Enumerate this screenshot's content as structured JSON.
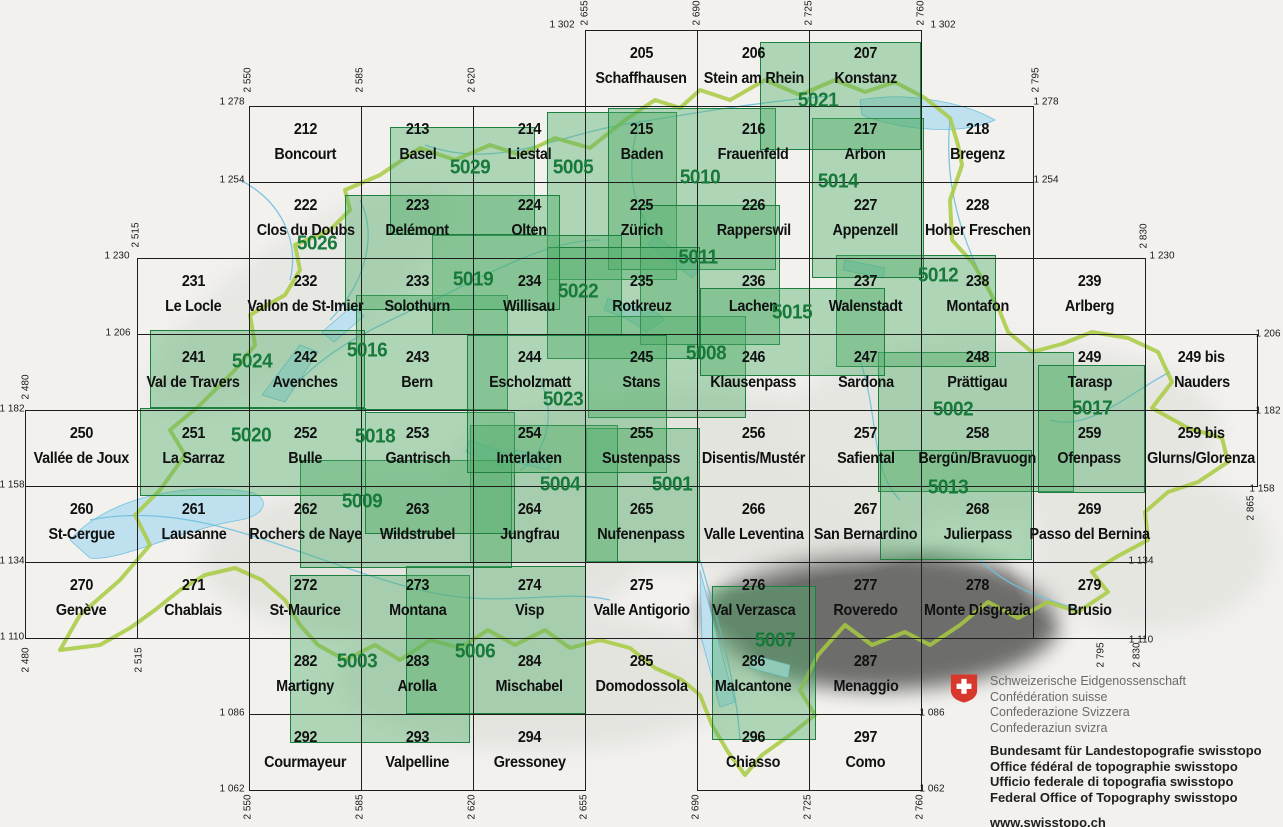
{
  "colors": {
    "composite_green": "#17793a",
    "composite_fill": "rgba(80,175,105,0.42)",
    "swiss_red": "#d8372c",
    "border_green": "#a8ca3f",
    "water_blue": "#6fc0dd"
  },
  "grid": {
    "x0_km": 2550,
    "x0_px": 249,
    "px_per_km_x": 3.2,
    "y0_km": 1302,
    "y0_px": 30,
    "px_per_km_y": 3.1667,
    "sheet_w_km": 35,
    "sheet_h_km": 24
  },
  "sheets": [
    {
      "n": "205",
      "name": "Schaffhausen",
      "x": 2655,
      "y": 1302
    },
    {
      "n": "206",
      "name": "Stein am Rhein",
      "x": 2690,
      "y": 1302
    },
    {
      "n": "207",
      "name": "Konstanz",
      "x": 2725,
      "y": 1302
    },
    {
      "n": "212",
      "name": "Boncourt",
      "x": 2550,
      "y": 1278
    },
    {
      "n": "213",
      "name": "Basel",
      "x": 2585,
      "y": 1278
    },
    {
      "n": "214",
      "name": "Liestal",
      "x": 2620,
      "y": 1278
    },
    {
      "n": "215",
      "name": "Baden",
      "x": 2655,
      "y": 1278
    },
    {
      "n": "216",
      "name": "Frauenfeld",
      "x": 2690,
      "y": 1278
    },
    {
      "n": "217",
      "name": "Arbon",
      "x": 2725,
      "y": 1278
    },
    {
      "n": "218",
      "name": "Bregenz",
      "x": 2760,
      "y": 1278
    },
    {
      "n": "222",
      "name": "Clos du Doubs",
      "x": 2550,
      "y": 1254
    },
    {
      "n": "223",
      "name": "Delémont",
      "x": 2585,
      "y": 1254
    },
    {
      "n": "224",
      "name": "Olten",
      "x": 2620,
      "y": 1254
    },
    {
      "n": "225",
      "name": "Zürich",
      "x": 2655,
      "y": 1254
    },
    {
      "n": "226",
      "name": "Rapperswil",
      "x": 2690,
      "y": 1254
    },
    {
      "n": "227",
      "name": "Appenzell",
      "x": 2725,
      "y": 1254
    },
    {
      "n": "228",
      "name": "Hoher Freschen",
      "x": 2760,
      "y": 1254
    },
    {
      "n": "231",
      "name": "Le Locle",
      "x": 2515,
      "y": 1230
    },
    {
      "n": "232",
      "name": "Vallon de St-Imier",
      "x": 2550,
      "y": 1230
    },
    {
      "n": "233",
      "name": "Solothurn",
      "x": 2585,
      "y": 1230
    },
    {
      "n": "234",
      "name": "Willisau",
      "x": 2620,
      "y": 1230
    },
    {
      "n": "235",
      "name": "Rotkreuz",
      "x": 2655,
      "y": 1230
    },
    {
      "n": "236",
      "name": "Lachen",
      "x": 2690,
      "y": 1230
    },
    {
      "n": "237",
      "name": "Walenstadt",
      "x": 2725,
      "y": 1230
    },
    {
      "n": "238",
      "name": "Montafon",
      "x": 2760,
      "y": 1230
    },
    {
      "n": "239",
      "name": "Arlberg",
      "x": 2795,
      "y": 1230
    },
    {
      "n": "241",
      "name": "Val de Travers",
      "x": 2515,
      "y": 1206
    },
    {
      "n": "242",
      "name": "Avenches",
      "x": 2550,
      "y": 1206
    },
    {
      "n": "243",
      "name": "Bern",
      "x": 2585,
      "y": 1206
    },
    {
      "n": "244",
      "name": "Escholzmatt",
      "x": 2620,
      "y": 1206
    },
    {
      "n": "245",
      "name": "Stans",
      "x": 2655,
      "y": 1206
    },
    {
      "n": "246",
      "name": "Klausenpass",
      "x": 2690,
      "y": 1206
    },
    {
      "n": "247",
      "name": "Sardona",
      "x": 2725,
      "y": 1206
    },
    {
      "n": "248",
      "name": "Prättigau",
      "x": 2760,
      "y": 1206
    },
    {
      "n": "249",
      "name": "Tarasp",
      "x": 2795,
      "y": 1206
    },
    {
      "n": "249 bis",
      "name": "Nauders",
      "x": 2830,
      "y": 1206
    },
    {
      "n": "250",
      "name": "Vallée de Joux",
      "x": 2480,
      "y": 1182
    },
    {
      "n": "251",
      "name": "La Sarraz",
      "x": 2515,
      "y": 1182
    },
    {
      "n": "252",
      "name": "Bulle",
      "x": 2550,
      "y": 1182
    },
    {
      "n": "253",
      "name": "Gantrisch",
      "x": 2585,
      "y": 1182
    },
    {
      "n": "254",
      "name": "Interlaken",
      "x": 2620,
      "y": 1182
    },
    {
      "n": "255",
      "name": "Sustenpass",
      "x": 2655,
      "y": 1182
    },
    {
      "n": "256",
      "name": "Disentis/Mustér",
      "x": 2690,
      "y": 1182
    },
    {
      "n": "257",
      "name": "Safiental",
      "x": 2725,
      "y": 1182
    },
    {
      "n": "258",
      "name": "Bergün/Bravuogn",
      "x": 2760,
      "y": 1182
    },
    {
      "n": "259",
      "name": "Ofenpass",
      "x": 2795,
      "y": 1182
    },
    {
      "n": "259 bis",
      "name": "Glurns/Glorenza",
      "x": 2830,
      "y": 1182
    },
    {
      "n": "260",
      "name": "St-Cergue",
      "x": 2480,
      "y": 1158
    },
    {
      "n": "261",
      "name": "Lausanne",
      "x": 2515,
      "y": 1158
    },
    {
      "n": "262",
      "name": "Rochers de Naye",
      "x": 2550,
      "y": 1158
    },
    {
      "n": "263",
      "name": "Wildstrubel",
      "x": 2585,
      "y": 1158
    },
    {
      "n": "264",
      "name": "Jungfrau",
      "x": 2620,
      "y": 1158
    },
    {
      "n": "265",
      "name": "Nufenenpass",
      "x": 2655,
      "y": 1158
    },
    {
      "n": "266",
      "name": "Valle Leventina",
      "x": 2690,
      "y": 1158
    },
    {
      "n": "267",
      "name": "San Bernardino",
      "x": 2725,
      "y": 1158
    },
    {
      "n": "268",
      "name": "Julierpass",
      "x": 2760,
      "y": 1158
    },
    {
      "n": "269",
      "name": "Passo del Bernina",
      "x": 2795,
      "y": 1158
    },
    {
      "n": "270",
      "name": "Genève",
      "x": 2480,
      "y": 1134
    },
    {
      "n": "271",
      "name": "Chablais",
      "x": 2515,
      "y": 1134
    },
    {
      "n": "272",
      "name": "St-Maurice",
      "x": 2550,
      "y": 1134
    },
    {
      "n": "273",
      "name": "Montana",
      "x": 2585,
      "y": 1134
    },
    {
      "n": "274",
      "name": "Visp",
      "x": 2620,
      "y": 1134
    },
    {
      "n": "275",
      "name": "Valle Antigorio",
      "x": 2655,
      "y": 1134
    },
    {
      "n": "276",
      "name": "Val Verzasca",
      "x": 2690,
      "y": 1134
    },
    {
      "n": "277",
      "name": "Roveredo",
      "x": 2725,
      "y": 1134
    },
    {
      "n": "278",
      "name": "Monte Disgrazia",
      "x": 2760,
      "y": 1134
    },
    {
      "n": "279",
      "name": "Brusio",
      "x": 2795,
      "y": 1134
    },
    {
      "n": "282",
      "name": "Martigny",
      "x": 2550,
      "y": 1110
    },
    {
      "n": "283",
      "name": "Arolla",
      "x": 2585,
      "y": 1110
    },
    {
      "n": "284",
      "name": "Mischabel",
      "x": 2620,
      "y": 1110
    },
    {
      "n": "285",
      "name": "Domodossola",
      "x": 2655,
      "y": 1110
    },
    {
      "n": "286",
      "name": "Malcantone",
      "x": 2690,
      "y": 1110
    },
    {
      "n": "287",
      "name": "Menaggio",
      "x": 2725,
      "y": 1110
    },
    {
      "n": "292",
      "name": "Courmayeur",
      "x": 2550,
      "y": 1086
    },
    {
      "n": "293",
      "name": "Valpelline",
      "x": 2585,
      "y": 1086
    },
    {
      "n": "294",
      "name": "Gressoney",
      "x": 2620,
      "y": 1086
    },
    {
      "n": "296",
      "name": "Chiasso",
      "x": 2690,
      "y": 1086
    },
    {
      "n": "297",
      "name": "Como",
      "x": 2725,
      "y": 1086
    }
  ],
  "composites": [
    {
      "n": "5001",
      "rect": [
        586,
        428,
        114,
        134
      ],
      "label": [
        672,
        485
      ]
    },
    {
      "n": "5002",
      "rect": [
        878,
        352,
        196,
        140
      ],
      "label": [
        953,
        410
      ]
    },
    {
      "n": "5003",
      "rect": [
        290,
        575,
        180,
        168
      ],
      "label": [
        357,
        662
      ]
    },
    {
      "n": "5004",
      "rect": [
        470,
        425,
        148,
        138
      ],
      "label": [
        560,
        485
      ]
    },
    {
      "n": "5005",
      "rect": [
        547,
        112,
        130,
        168
      ],
      "label": [
        573,
        168
      ]
    },
    {
      "n": "5006",
      "rect": [
        406,
        566,
        180,
        148
      ],
      "label": [
        475,
        652
      ]
    },
    {
      "n": "5007",
      "rect": [
        712,
        586,
        104,
        154
      ],
      "label": [
        775,
        641
      ]
    },
    {
      "n": "5008",
      "rect": [
        588,
        316,
        158,
        102
      ],
      "label": [
        706,
        354
      ]
    },
    {
      "n": "5009",
      "rect": [
        300,
        460,
        212,
        108
      ],
      "label": [
        362,
        502
      ]
    },
    {
      "n": "5010",
      "rect": [
        608,
        108,
        168,
        162
      ],
      "label": [
        700,
        178
      ]
    },
    {
      "n": "5011",
      "rect": [
        640,
        205,
        140,
        140
      ],
      "label": [
        698,
        258
      ]
    },
    {
      "n": "5012",
      "rect": [
        836,
        255,
        160,
        112
      ],
      "label": [
        938,
        276
      ]
    },
    {
      "n": "5013",
      "rect": [
        880,
        450,
        152,
        110
      ],
      "label": [
        948,
        488
      ]
    },
    {
      "n": "5014",
      "rect": [
        812,
        118,
        112,
        160
      ],
      "label": [
        838,
        182
      ]
    },
    {
      "n": "5015",
      "rect": [
        700,
        288,
        185,
        88
      ],
      "label": [
        792,
        313
      ]
    },
    {
      "n": "5016",
      "rect": [
        356,
        295,
        152,
        115
      ],
      "label": [
        367,
        351
      ]
    },
    {
      "n": "5017",
      "rect": [
        1038,
        365,
        107,
        128
      ],
      "label": [
        1092,
        409
      ]
    },
    {
      "n": "5018",
      "rect": [
        365,
        412,
        150,
        122
      ],
      "label": [
        375,
        437
      ]
    },
    {
      "n": "5019",
      "rect": [
        432,
        235,
        190,
        100
      ],
      "label": [
        473,
        280
      ]
    },
    {
      "n": "5020",
      "rect": [
        140,
        408,
        226,
        88
      ],
      "label": [
        251,
        436
      ]
    },
    {
      "n": "5021",
      "rect": [
        760,
        42,
        161,
        108
      ],
      "label": [
        818,
        101
      ]
    },
    {
      "n": "5022",
      "rect": [
        547,
        247,
        153,
        112
      ],
      "label": [
        578,
        292
      ]
    },
    {
      "n": "5023",
      "rect": [
        467,
        335,
        200,
        138
      ],
      "label": [
        563,
        400
      ]
    },
    {
      "n": "5024",
      "rect": [
        150,
        330,
        215,
        78
      ],
      "label": [
        252,
        362
      ]
    },
    {
      "n": "5026",
      "rect": [
        345,
        195,
        215,
        115
      ],
      "label": [
        317,
        244
      ]
    },
    {
      "n": "5029",
      "rect": [
        390,
        127,
        145,
        108
      ],
      "label": [
        470,
        168
      ]
    }
  ],
  "edge_labels": {
    "horizontal": [
      {
        "t": "1 302",
        "x": 562,
        "y": 25
      },
      {
        "t": "1 302",
        "x": 943,
        "y": 25
      },
      {
        "t": "1 278",
        "x": 232,
        "y": 102
      },
      {
        "t": "1 278",
        "x": 1046,
        "y": 102
      },
      {
        "t": "1 254",
        "x": 232,
        "y": 180
      },
      {
        "t": "1 254",
        "x": 1046,
        "y": 180
      },
      {
        "t": "1 230",
        "x": 117,
        "y": 256
      },
      {
        "t": "1 230",
        "x": 1162,
        "y": 256
      },
      {
        "t": "1 206",
        "x": 118,
        "y": 333
      },
      {
        "t": "1 206",
        "x": 1268,
        "y": 334
      },
      {
        "t": "1 182",
        "x": 12,
        "y": 409
      },
      {
        "t": "1 182",
        "x": 1268,
        "y": 411
      },
      {
        "t": "1 158",
        "x": 12,
        "y": 485
      },
      {
        "t": "1 158",
        "x": 1262,
        "y": 489
      },
      {
        "t": "1 134",
        "x": 12,
        "y": 561
      },
      {
        "t": "1 134",
        "x": 1141,
        "y": 561
      },
      {
        "t": "1 110",
        "x": 12,
        "y": 637
      },
      {
        "t": "1 110",
        "x": 1141,
        "y": 640
      },
      {
        "t": "1 086",
        "x": 232,
        "y": 713
      },
      {
        "t": "1 086",
        "x": 932,
        "y": 713
      },
      {
        "t": "1 062",
        "x": 232,
        "y": 789
      },
      {
        "t": "1 062",
        "x": 932,
        "y": 789
      }
    ],
    "vertical": [
      {
        "t": "2 655",
        "x": 585,
        "y": 13
      },
      {
        "t": "2 690",
        "x": 697,
        "y": 13
      },
      {
        "t": "2 725",
        "x": 809,
        "y": 13
      },
      {
        "t": "2 760",
        "x": 921,
        "y": 13
      },
      {
        "t": "2 550",
        "x": 248,
        "y": 80
      },
      {
        "t": "2 585",
        "x": 360,
        "y": 80
      },
      {
        "t": "2 620",
        "x": 472,
        "y": 80
      },
      {
        "t": "2 795",
        "x": 1036,
        "y": 80
      },
      {
        "t": "2 515",
        "x": 136,
        "y": 235
      },
      {
        "t": "2 830",
        "x": 1144,
        "y": 236
      },
      {
        "t": "2 480",
        "x": 26,
        "y": 387
      },
      {
        "t": "2 865",
        "x": 1251,
        "y": 508
      },
      {
        "t": "2 480",
        "x": 26,
        "y": 660
      },
      {
        "t": "2 515",
        "x": 139,
        "y": 660
      },
      {
        "t": "2 795",
        "x": 1101,
        "y": 655
      },
      {
        "t": "2 830",
        "x": 1137,
        "y": 655
      },
      {
        "t": "2 550",
        "x": 248,
        "y": 807
      },
      {
        "t": "2 585",
        "x": 360,
        "y": 807
      },
      {
        "t": "2 620",
        "x": 472,
        "y": 807
      },
      {
        "t": "2 655",
        "x": 584,
        "y": 807
      },
      {
        "t": "2 690",
        "x": 696,
        "y": 807
      },
      {
        "t": "2 725",
        "x": 808,
        "y": 807
      },
      {
        "t": "2 760",
        "x": 920,
        "y": 807
      }
    ]
  },
  "footer": {
    "confederation_lines": [
      "Schweizerische Eidgenossenschaft",
      "Confédération suisse",
      "Confederazione Svizzera",
      "Confederaziun svizra"
    ],
    "office_lines": [
      "Bundesamt für Landestopografie swisstopo",
      "Office fédéral de topographie swisstopo",
      "Ufficio federale di topografia swisstopo",
      "Federal Office of Topography swisstopo"
    ],
    "url": "www.swisstopo.ch"
  }
}
